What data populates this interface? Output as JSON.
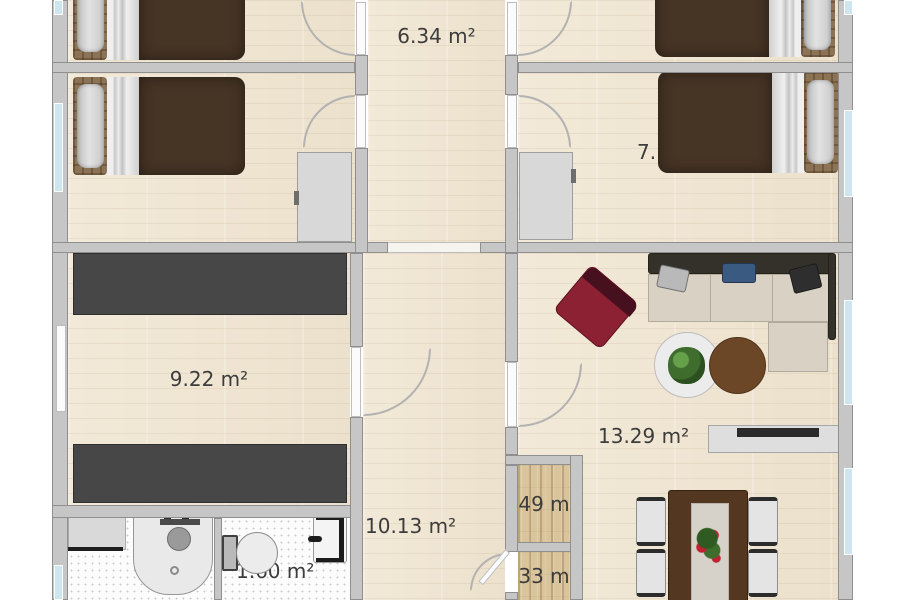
{
  "floorplan": {
    "labels": {
      "hallway_top": "6.34 m²",
      "bedroom_left_2_partial": "2",
      "bedroom_right_2_partial": "7.",
      "storage_room": "9.22 m²",
      "hall": "10.13 m²",
      "living_room": "13.29 m²",
      "closet_upper": "49 m",
      "closet_lower": "33 m",
      "wc": "1.60 m²"
    },
    "colors": {
      "wall": "#c6c6c6",
      "floor_wood": "#efe6d3",
      "closet_wood": "#d9c49c",
      "bathroom_tile": "#fcfcfc",
      "window_glass": "#cde6f0",
      "door_leaf": "#fbfbfb",
      "wardrobe": "#474747",
      "bed_blanket": "#463425",
      "sofa_seat": "#d9d1c3",
      "sofa_back": "#34312b",
      "armchair_accent": "#8c2134",
      "coffee_table_brown": "#6b4728",
      "dining_table": "#543720",
      "label_text": "#3c3c3c"
    },
    "furniture": {
      "beds": "double-bed",
      "wardrobes": "dark-wardrobe",
      "sofa": "corner-sofa",
      "armchair": "accent-armchair",
      "round_table": "round-side-table-with-plant",
      "rug": "round-brown-rug",
      "tv_board": "tv-sideboard",
      "dining": "dining-table-with-four-chairs",
      "shower": "corner-shower",
      "toilet": "toilet",
      "washer": "bathroom-counter",
      "cabinet": "tall-cabinet"
    }
  }
}
